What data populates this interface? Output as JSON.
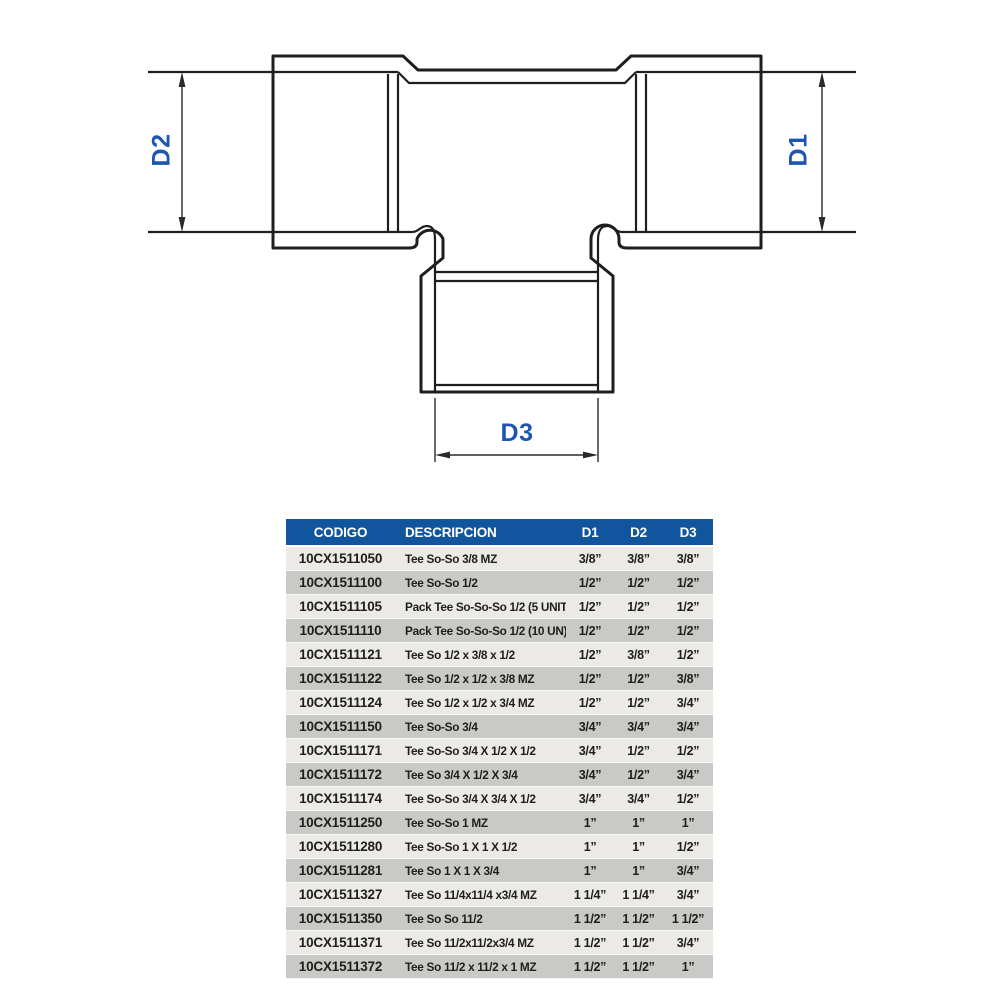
{
  "diagram": {
    "type": "tee-fitting-dimension-drawing",
    "d1_label": "D1",
    "d2_label": "D2",
    "d3_label": "D3"
  },
  "table": {
    "headers": [
      "CODIGO",
      "DESCRIPCION",
      "D1",
      "D2",
      "D3"
    ],
    "rows": [
      {
        "codigo": "10CX1511050",
        "descripcion": "Tee So-So 3/8 MZ",
        "d1": "3/8”",
        "d2": "3/8”",
        "d3": "3/8”"
      },
      {
        "codigo": "10CX1511100",
        "descripcion": "Tee So-So 1/2",
        "d1": "1/2”",
        "d2": "1/2”",
        "d3": "1/2”"
      },
      {
        "codigo": "10CX1511105",
        "descripcion": "Pack Tee So-So-So 1/2 (5 UNITS)",
        "d1": "1/2”",
        "d2": "1/2”",
        "d3": "1/2”"
      },
      {
        "codigo": "10CX1511110",
        "descripcion": "Pack Tee So-So-So 1/2 (10 UN)",
        "d1": "1/2”",
        "d2": "1/2”",
        "d3": "1/2”"
      },
      {
        "codigo": "10CX1511121",
        "descripcion": "Tee So 1/2 x 3/8 x 1/2",
        "d1": "1/2”",
        "d2": "3/8”",
        "d3": "1/2”"
      },
      {
        "codigo": "10CX1511122",
        "descripcion": "Tee So 1/2 x 1/2 x 3/8 MZ",
        "d1": "1/2”",
        "d2": "1/2”",
        "d3": "3/8”"
      },
      {
        "codigo": "10CX1511124",
        "descripcion": "Tee So 1/2 x 1/2 x 3/4 MZ",
        "d1": "1/2”",
        "d2": "1/2”",
        "d3": "3/4”"
      },
      {
        "codigo": "10CX1511150",
        "descripcion": "Tee So-So 3/4",
        "d1": "3/4”",
        "d2": "3/4”",
        "d3": "3/4”"
      },
      {
        "codigo": "10CX1511171",
        "descripcion": "Tee So-So 3/4 X 1/2 X 1/2",
        "d1": "3/4”",
        "d2": "1/2”",
        "d3": "1/2”"
      },
      {
        "codigo": "10CX1511172",
        "descripcion": "Tee So 3/4 X 1/2 X 3/4",
        "d1": "3/4”",
        "d2": "1/2”",
        "d3": "3/4”"
      },
      {
        "codigo": "10CX1511174",
        "descripcion": "Tee So-So 3/4 X 3/4 X 1/2",
        "d1": "3/4”",
        "d2": "3/4”",
        "d3": "1/2”"
      },
      {
        "codigo": "10CX1511250",
        "descripcion": "Tee So-So 1 MZ",
        "d1": "1”",
        "d2": "1”",
        "d3": "1”"
      },
      {
        "codigo": "10CX1511280",
        "descripcion": "Tee So-So 1 X 1 X 1/2",
        "d1": "1”",
        "d2": "1”",
        "d3": "1/2”"
      },
      {
        "codigo": "10CX1511281",
        "descripcion": "Tee So 1 X 1 X 3/4",
        "d1": "1”",
        "d2": "1”",
        "d3": "3/4”"
      },
      {
        "codigo": "10CX1511327",
        "descripcion": "Tee So 11/4x11/4 x3/4 MZ",
        "d1": "1 1/4”",
        "d2": "1 1/4”",
        "d3": "3/4”"
      },
      {
        "codigo": "10CX1511350",
        "descripcion": "Tee So So 11/2",
        "d1": "1 1/2”",
        "d2": "1 1/2”",
        "d3": "1 1/2”"
      },
      {
        "codigo": "10CX1511371",
        "descripcion": "Tee So 11/2x11/2x3/4 MZ",
        "d1": "1 1/2”",
        "d2": "1 1/2”",
        "d3": "3/4”"
      },
      {
        "codigo": "10CX1511372",
        "descripcion": "Tee So 11/2 x 11/2 x 1 MZ",
        "d1": "1 1/2”",
        "d2": "1 1/2”",
        "d3": "1”"
      }
    ]
  },
  "colors": {
    "header_bg": "#12559f",
    "header_text": "#ffffff",
    "row_light": "#ebeae6",
    "row_dark": "#c9c9c7",
    "body_text": "#1f1e1c",
    "drawing_line": "#1e1e1e",
    "dim_label_blue": "#1d55b0"
  }
}
